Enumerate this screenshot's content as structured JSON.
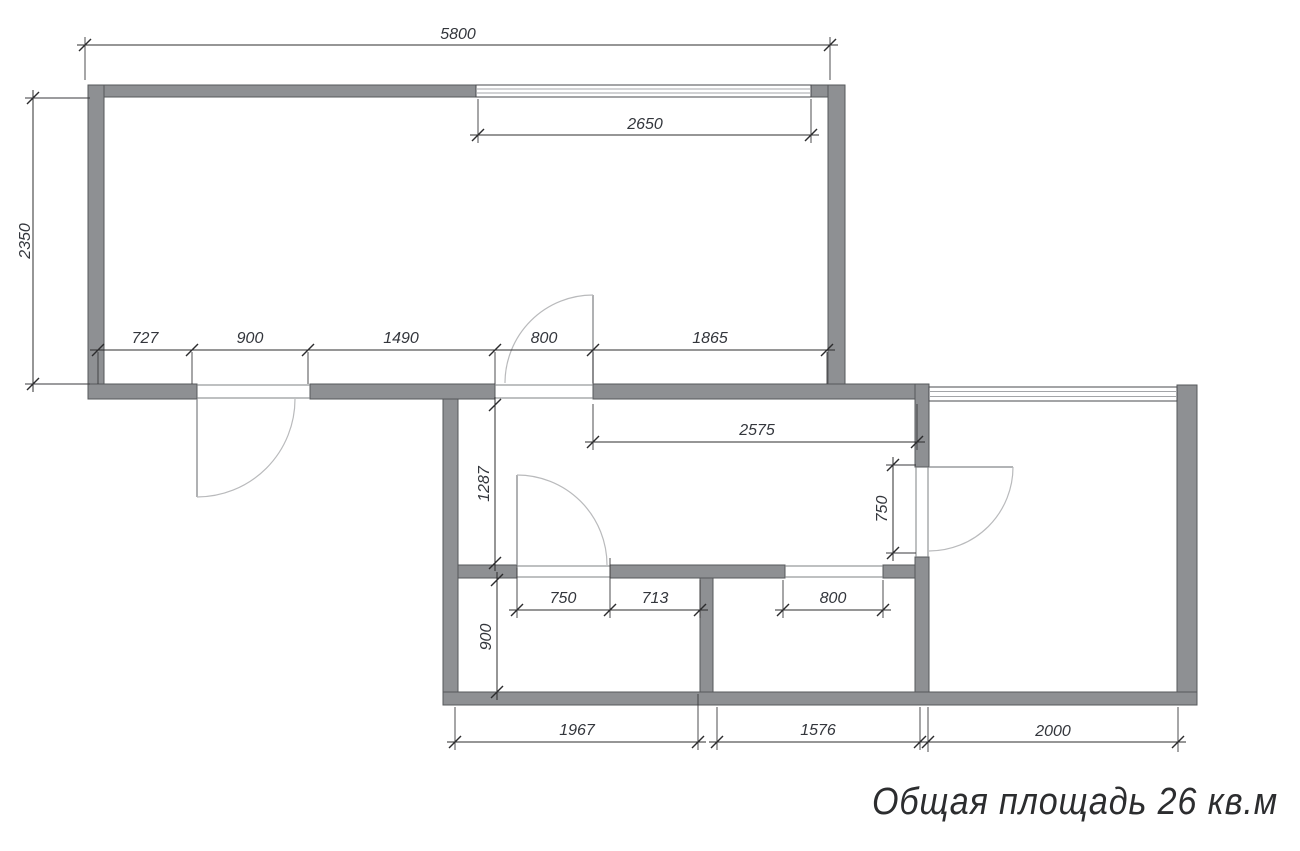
{
  "plan": {
    "caption": "Общая площадь 26 кв.м"
  },
  "dimensions": {
    "top_total": "5800",
    "top_window": "2650",
    "left_height": "2350",
    "row": [
      "727",
      "900",
      "1490",
      "800",
      "1865"
    ],
    "hall_length": "2575",
    "hall_width": "1287",
    "right_door": "750",
    "bath_door": "750",
    "seg_713": "713",
    "kitchen_opening": "800",
    "room_depth": "900",
    "bottom_left": "1967",
    "bottom_middle": "1576",
    "bottom_right": "2000"
  }
}
